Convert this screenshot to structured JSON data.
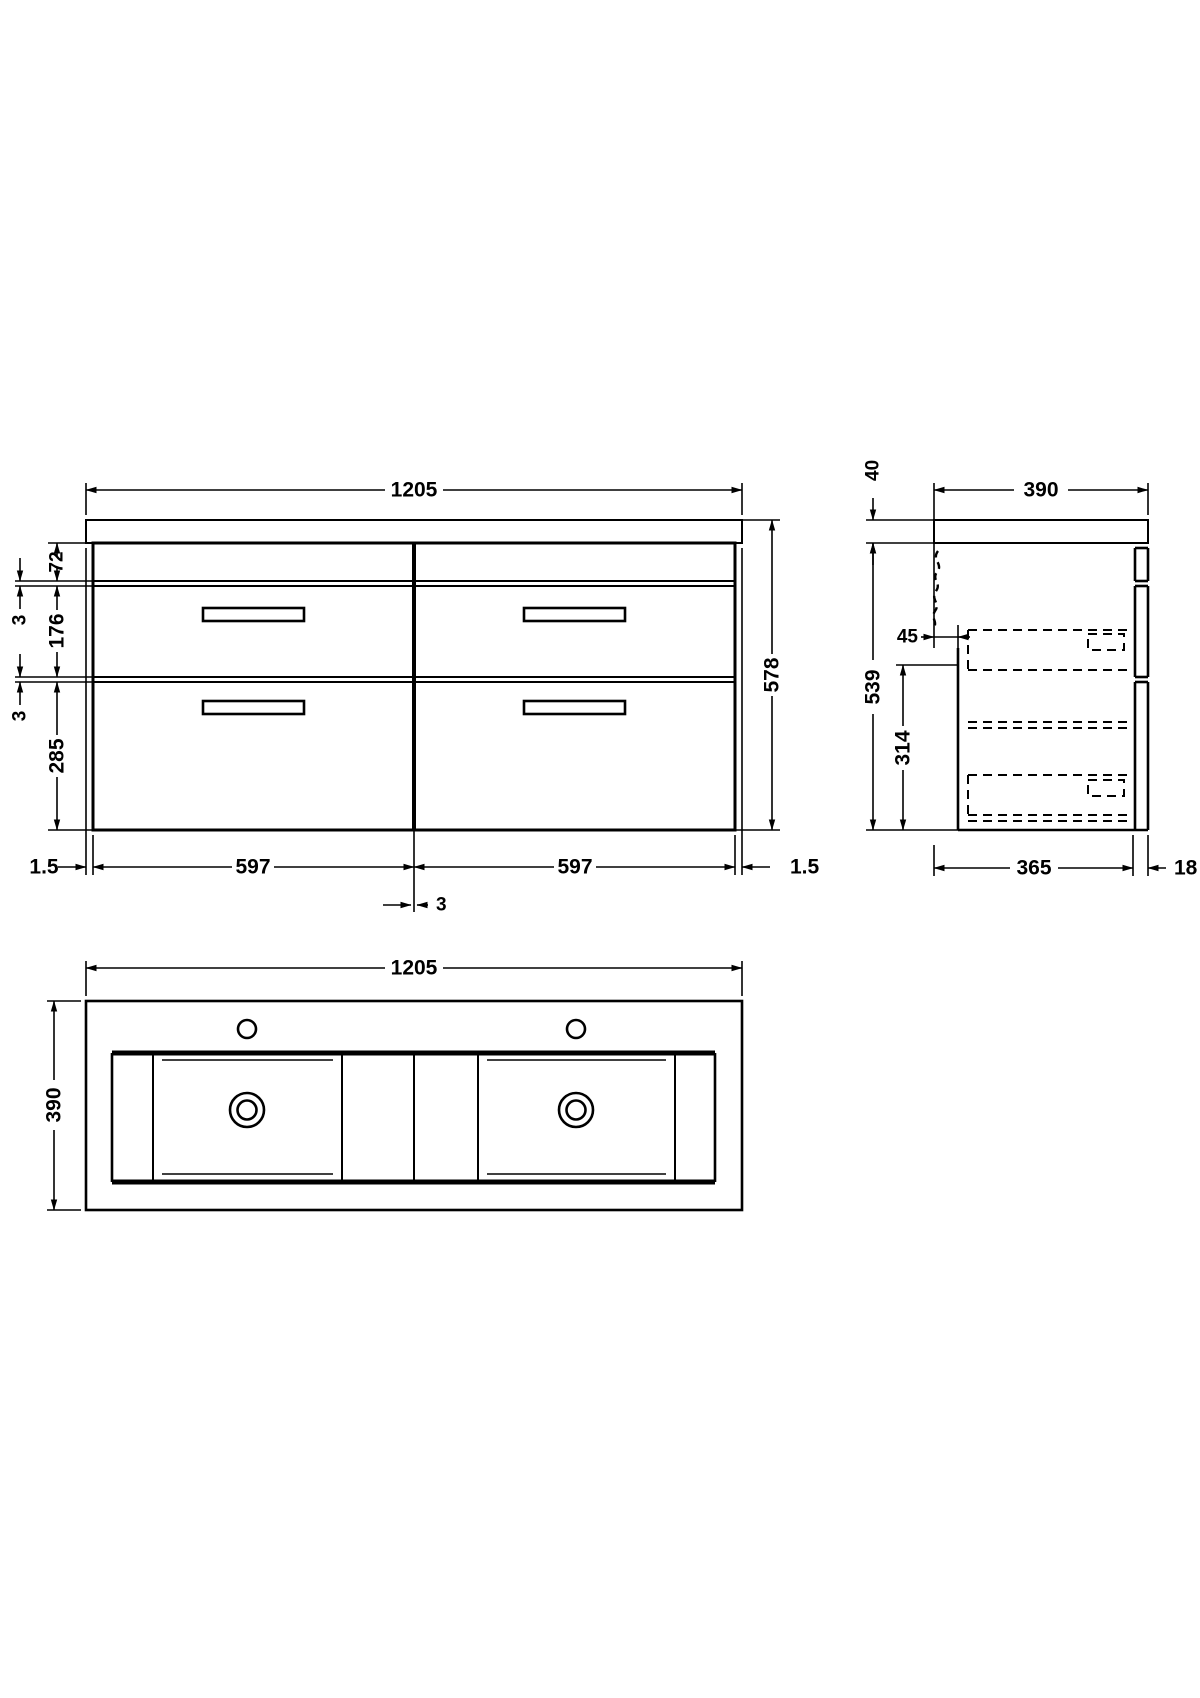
{
  "drawing_type": "vanity-unit-technical-drawing",
  "front_view": {
    "width": "1205",
    "top_section": "72",
    "gap_top": "3",
    "upper_drawer": "176",
    "gap_middle": "3",
    "lower_drawer": "285",
    "height": "578",
    "left_offset": "1.5",
    "left_door": "597",
    "right_door": "597",
    "right_offset": "1.5",
    "divider_gap": "3"
  },
  "side_view": {
    "worktop": "40",
    "depth": "390",
    "bracket_offset": "45",
    "carcass_height": "539",
    "lower_section": "314",
    "carcass_depth": "365",
    "front_panel": "18"
  },
  "plan_view": {
    "width": "1205",
    "depth": "390"
  }
}
